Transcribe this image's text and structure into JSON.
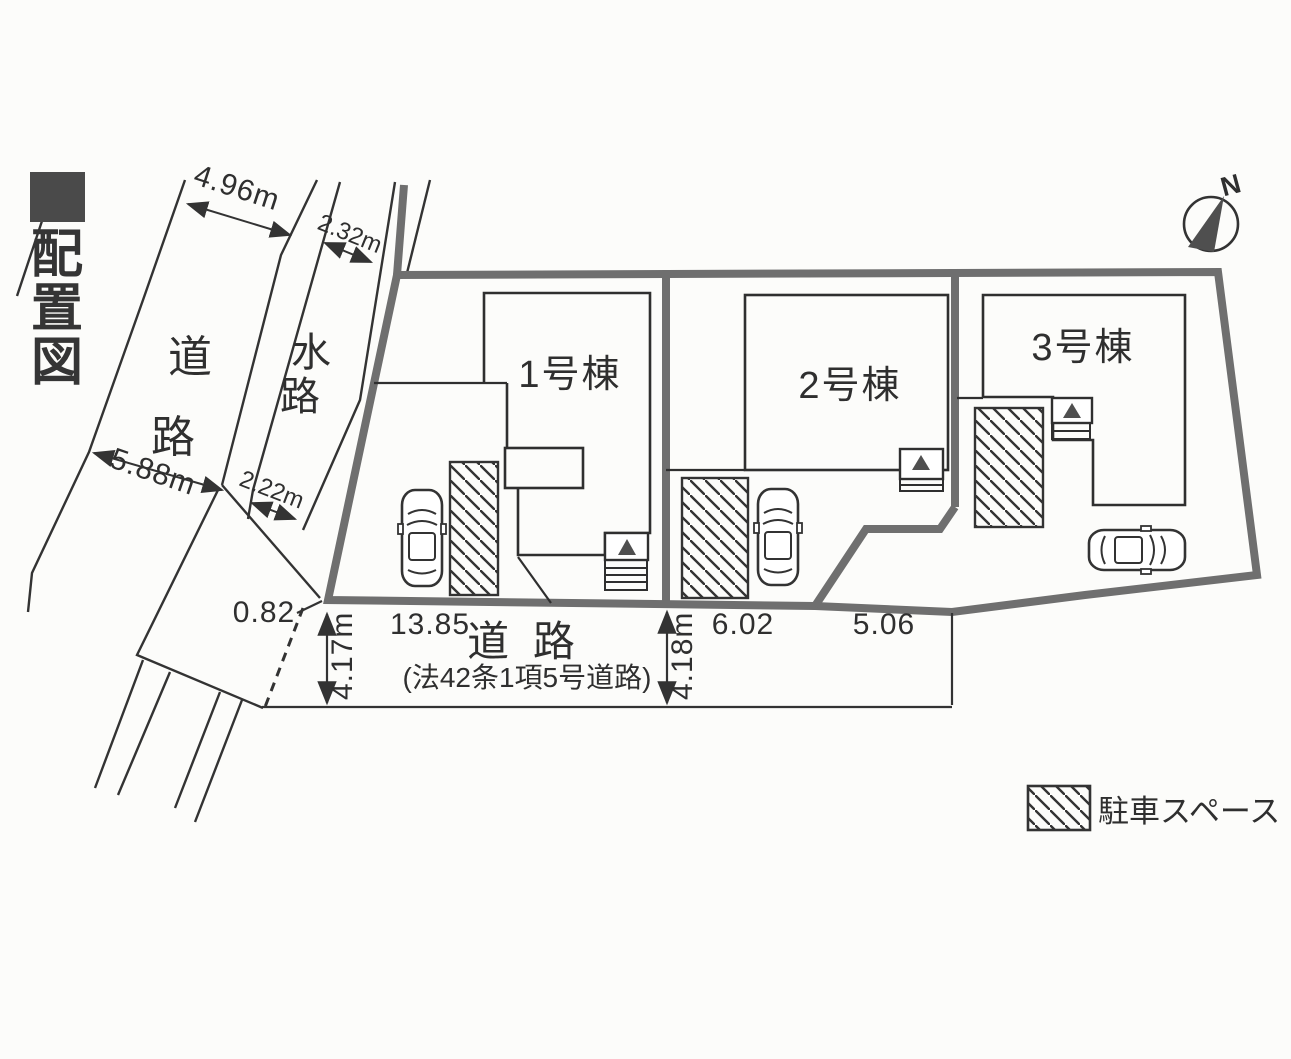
{
  "page": {
    "title": "配置図",
    "title_chars": [
      "配",
      "置",
      "図"
    ]
  },
  "compass": {
    "north_label": "N"
  },
  "left_roads": {
    "road": {
      "name": "道路",
      "chars": [
        "道",
        "路"
      ],
      "width_top": "4.96m",
      "width_bottom": "5.88m"
    },
    "waterway": {
      "name": "水路",
      "chars": [
        "水",
        "路"
      ],
      "width_top": "2.32m",
      "width_bottom": "2.22m"
    }
  },
  "site": {
    "buildings": [
      {
        "label": "1号棟"
      },
      {
        "label": "2号棟"
      },
      {
        "label": "3号棟"
      }
    ]
  },
  "front_road": {
    "title": "道 路",
    "subtitle": "(法42条1項5号道路)",
    "corner_offset": "0.82",
    "width_left": "4.17m",
    "width_right": "4.18m",
    "frontages": [
      "13.85",
      "6.02",
      "5.06"
    ]
  },
  "legend": {
    "parking": "駐車スペース"
  },
  "colors": {
    "boundary_thick": "#6f6f6f",
    "line_thin": "#333333",
    "triangle_fill": "#4f4f4f",
    "paper": "#fcfcfa"
  }
}
